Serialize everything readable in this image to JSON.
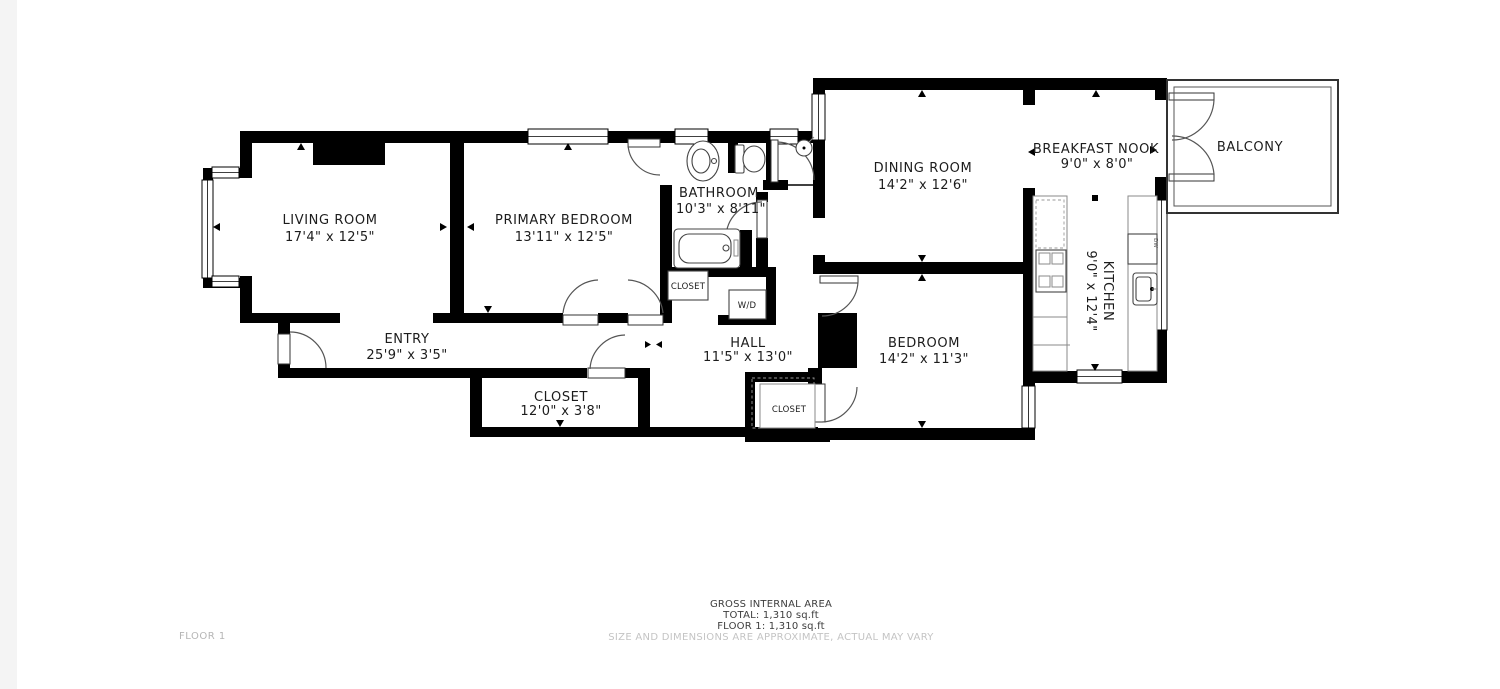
{
  "plan": {
    "rooms": {
      "living_room": {
        "name": "LIVING ROOM",
        "dims": "17'4\" x 12'5\""
      },
      "primary_bedroom": {
        "name": "PRIMARY BEDROOM",
        "dims": "13'11\" x 12'5\""
      },
      "bathroom": {
        "name": "BATHROOM",
        "dims": "10'3\" x 8'11\""
      },
      "entry": {
        "name": "ENTRY",
        "dims": "25'9\" x 3'5\""
      },
      "hall": {
        "name": "HALL",
        "dims": "11'5\" x 13'0\""
      },
      "closet": {
        "name": "CLOSET",
        "dims": "12'0\" x 3'8\""
      },
      "dining_room": {
        "name": "DINING ROOM",
        "dims": "14'2\" x 12'6\""
      },
      "bedroom": {
        "name": "BEDROOM",
        "dims": "14'2\" x 11'3\""
      },
      "breakfast_nook": {
        "name": "BREAKFAST NOOK",
        "dims": "9'0\" x 8'0\""
      },
      "kitchen": {
        "name": "KITCHEN",
        "dims": "9'0\" x 12'4\""
      },
      "balcony": {
        "name": "BALCONY"
      }
    },
    "small_labels": {
      "bathroom_closet": "CLOSET",
      "bedroom_closet": "CLOSET",
      "washer_dryer": "W/D",
      "dishwasher": "DW"
    },
    "footer": {
      "area_title": "GROSS INTERNAL AREA",
      "total": "TOTAL: 1,310 sq.ft",
      "floor_total": "FLOOR 1: 1,310 sq.ft",
      "disclaimer": "SIZE AND DIMENSIONS ARE APPROXIMATE, ACTUAL MAY VARY",
      "floor_label": "FLOOR 1"
    },
    "colors": {
      "wall": "#000000",
      "background": "#ffffff",
      "label_text": "#1c1c1c",
      "muted_text": "#c4c4c4",
      "side_strip": "#f4f4f4"
    }
  }
}
